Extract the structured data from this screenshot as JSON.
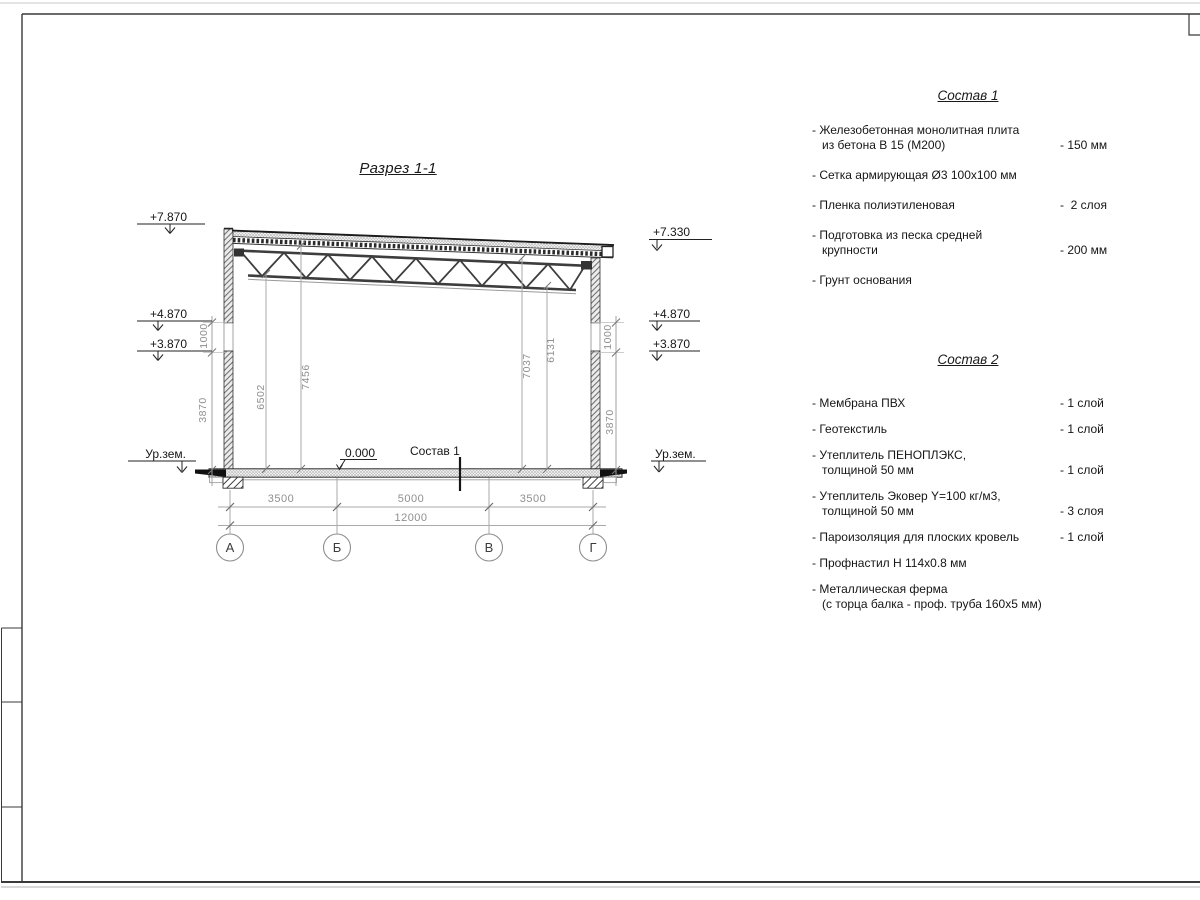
{
  "colors": {
    "frame_line": "#3a3a3a",
    "drawing_line": "#2f2f2f",
    "dimension_gray": "#8f8f8f",
    "text_black": "#161616"
  },
  "drawing": {
    "title": "Разрез 1-1",
    "zero_level": "0.000",
    "slab_label": "Состав 1",
    "ground_label_left": "Ур.зем.",
    "ground_label_right": "Ур.зем.",
    "elevations_left": [
      "+7.870",
      "+4.870",
      "+3.870"
    ],
    "elevations_right": [
      "+7.330",
      "+4.870",
      "+3.870"
    ],
    "vertical_dims": {
      "left_top": "1000",
      "left_bottom": "3870",
      "inner_1": "6502",
      "inner_2": "7456",
      "inner_3": "7037",
      "inner_4": "6131",
      "right_top": "1000",
      "right_bottom": "3870"
    },
    "bottom_dims": {
      "span_ab": "3500",
      "span_bv": "5000",
      "span_vg": "3500",
      "total": "12000"
    },
    "axes": [
      "А",
      "Б",
      "В",
      "Г"
    ]
  },
  "composition1": {
    "title": "Состав 1",
    "items": [
      {
        "name": "- Железобетонная  монолитная плита\nиз бетона В 15 (М200)",
        "value": "- 150 мм"
      },
      {
        "name": "- Сетка армирующая Ø3 100х100 мм",
        "value": ""
      },
      {
        "name": "- Пленка полиэтиленовая",
        "value": "-  2 слоя"
      },
      {
        "name": "- Подготовка из песка средней\nкрупности",
        "value": "- 200 мм"
      },
      {
        "name": "- Грунт основания",
        "value": ""
      }
    ]
  },
  "composition2": {
    "title": "Состав 2",
    "items": [
      {
        "name": "- Мембрана ПВХ",
        "value": "- 1 слой"
      },
      {
        "name": "- Геотекстиль",
        "value": "- 1 слой"
      },
      {
        "name": "- Утеплитель ПЕНОПЛЭКС,\nтолщиной 50 мм",
        "value": "- 1 слой"
      },
      {
        "name": "- Утеплитель Эковер Y=100 кг/м3,\nтолщиной 50 мм",
        "value": "- 3 слоя"
      },
      {
        "name": "- Пароизоляция для плоских кровель",
        "value": "- 1 слой"
      },
      {
        "name": "- Профнастил Н 114х0.8 мм",
        "value": ""
      },
      {
        "name": "- Металлическая ферма\n(с торца балка - проф. труба 160х5 мм)",
        "value": ""
      }
    ]
  }
}
